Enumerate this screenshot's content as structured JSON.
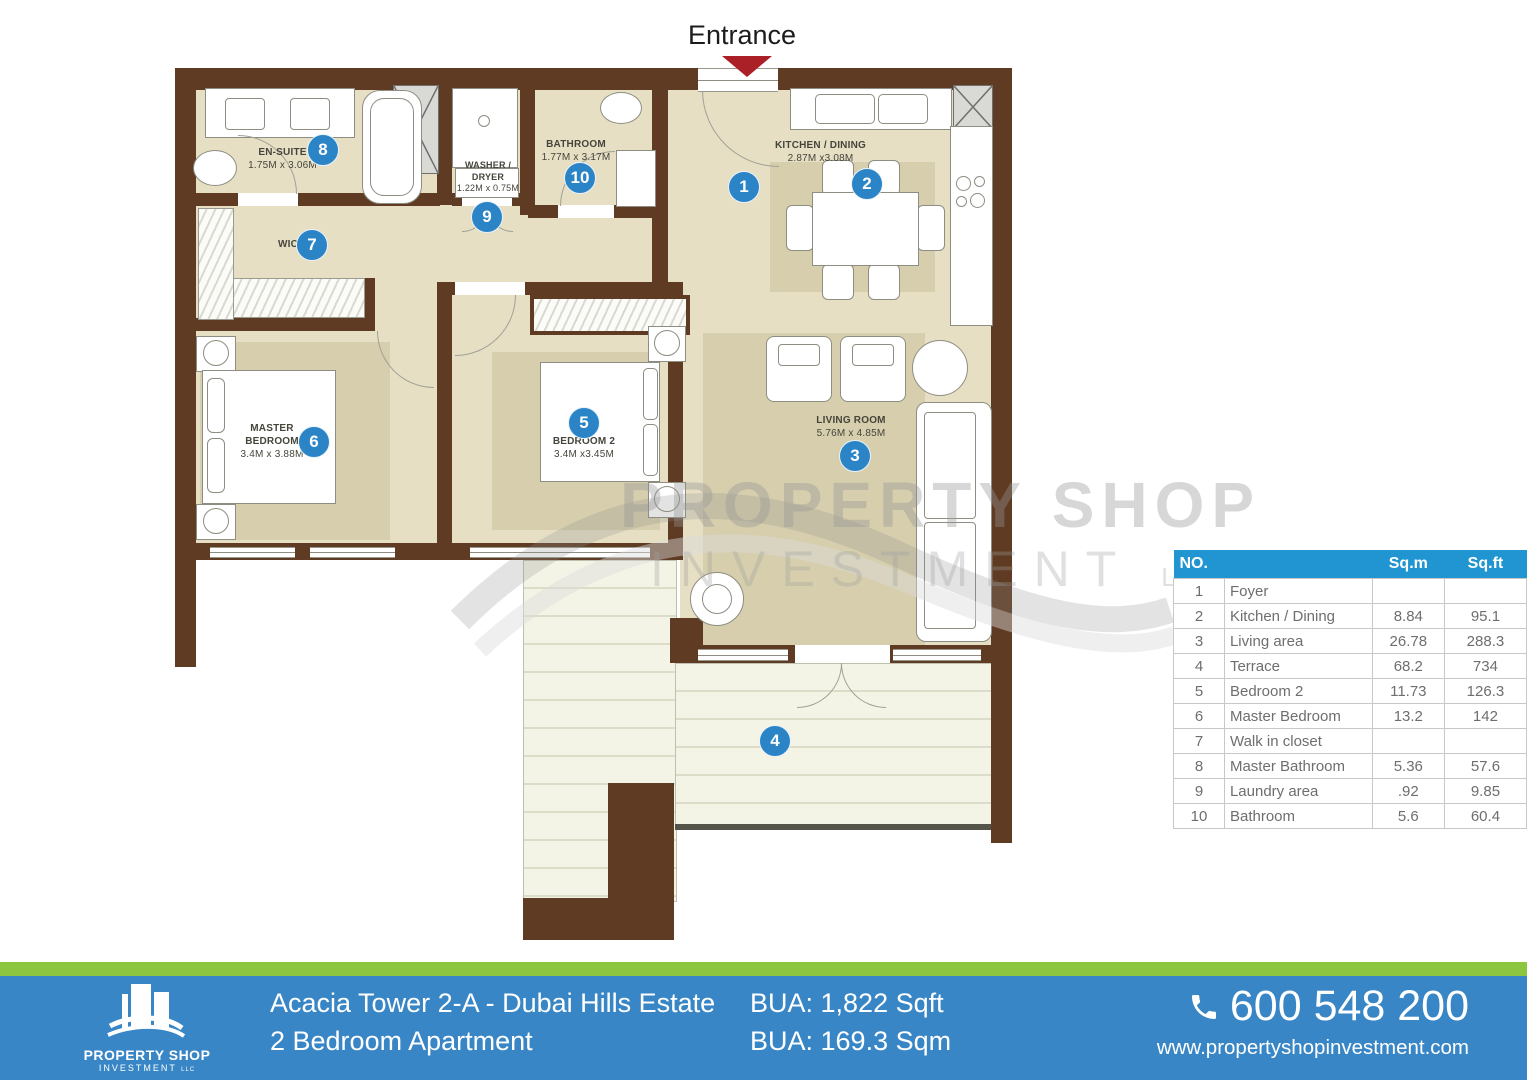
{
  "entrance": {
    "label": "Entrance"
  },
  "watermark": {
    "line1": "PROPERTY SHOP",
    "line2": "INVESTMENT",
    "suffix": "LLC"
  },
  "plan": {
    "labels": {
      "ensuite_name": "EN-SUITE",
      "ensuite_dims": "1.75M x 3.06M",
      "washer_line1": "WASHER /",
      "washer_line2": "DRYER",
      "washer_dims": "1.22M x 0.75M",
      "bathroom_name": "BATHROOM",
      "bathroom_dims": "1.77M x 3.17M",
      "kitchen_name": "KITCHEN / DINING",
      "kitchen_dims": "2.87M x3.08M",
      "wic_name": "WIC",
      "master_line1": "MASTER",
      "master_line2": "BEDROOM",
      "master_dims": "3.4M x 3.88M",
      "bedroom2_name": "BEDROOM 2",
      "bedroom2_dims": "3.4M x3.45M",
      "living_name": "LIVING ROOM",
      "living_dims": "5.76M x 4.85M"
    },
    "markers": [
      "1",
      "2",
      "3",
      "4",
      "5",
      "6",
      "7",
      "8",
      "9",
      "10"
    ]
  },
  "table": {
    "headers": {
      "no": "NO.",
      "sqm": "Sq.m",
      "sqft": "Sq.ft"
    },
    "rows": [
      {
        "no": "1",
        "name": "Foyer",
        "sqm": "",
        "sqft": ""
      },
      {
        "no": "2",
        "name": "Kitchen / Dining",
        "sqm": "8.84",
        "sqft": "95.1"
      },
      {
        "no": "3",
        "name": "Living area",
        "sqm": "26.78",
        "sqft": "288.3"
      },
      {
        "no": "4",
        "name": "Terrace",
        "sqm": "68.2",
        "sqft": "734"
      },
      {
        "no": "5",
        "name": "Bedroom 2",
        "sqm": "11.73",
        "sqft": "126.3"
      },
      {
        "no": "6",
        "name": "Master Bedroom",
        "sqm": "13.2",
        "sqft": "142"
      },
      {
        "no": "7",
        "name": "Walk in closet",
        "sqm": "",
        "sqft": ""
      },
      {
        "no": "8",
        "name": "Master Bathroom",
        "sqm": "5.36",
        "sqft": "57.6"
      },
      {
        "no": "9",
        "name": "Laundry area",
        "sqm": ".92",
        "sqft": "9.85"
      },
      {
        "no": "10",
        "name": "Bathroom",
        "sqm": "5.6",
        "sqft": "60.4"
      }
    ]
  },
  "footer": {
    "title_line1": "Acacia Tower 2-A - Dubai Hills Estate",
    "title_line2": "2 Bedroom Apartment",
    "bua_line1": "BUA: 1,822 Sqft",
    "bua_line2": "BUA: 169.3 Sqm",
    "phone": "600 548 200",
    "website": "www.propertyshopinvestment.com",
    "logo_line1": "PROPERTY SHOP",
    "logo_line2": "INVESTMENT",
    "logo_suffix": "LLC"
  },
  "colors": {
    "wall_brown": "#5f3b23",
    "floor_beige": "#e6dfc4",
    "rug_beige": "#d6ceac",
    "marker_blue": "#2b84c6",
    "table_header_blue": "#2095d2",
    "footer_blue": "#3886c5",
    "footer_green": "#8cc640",
    "entrance_red": "#ab2026"
  }
}
